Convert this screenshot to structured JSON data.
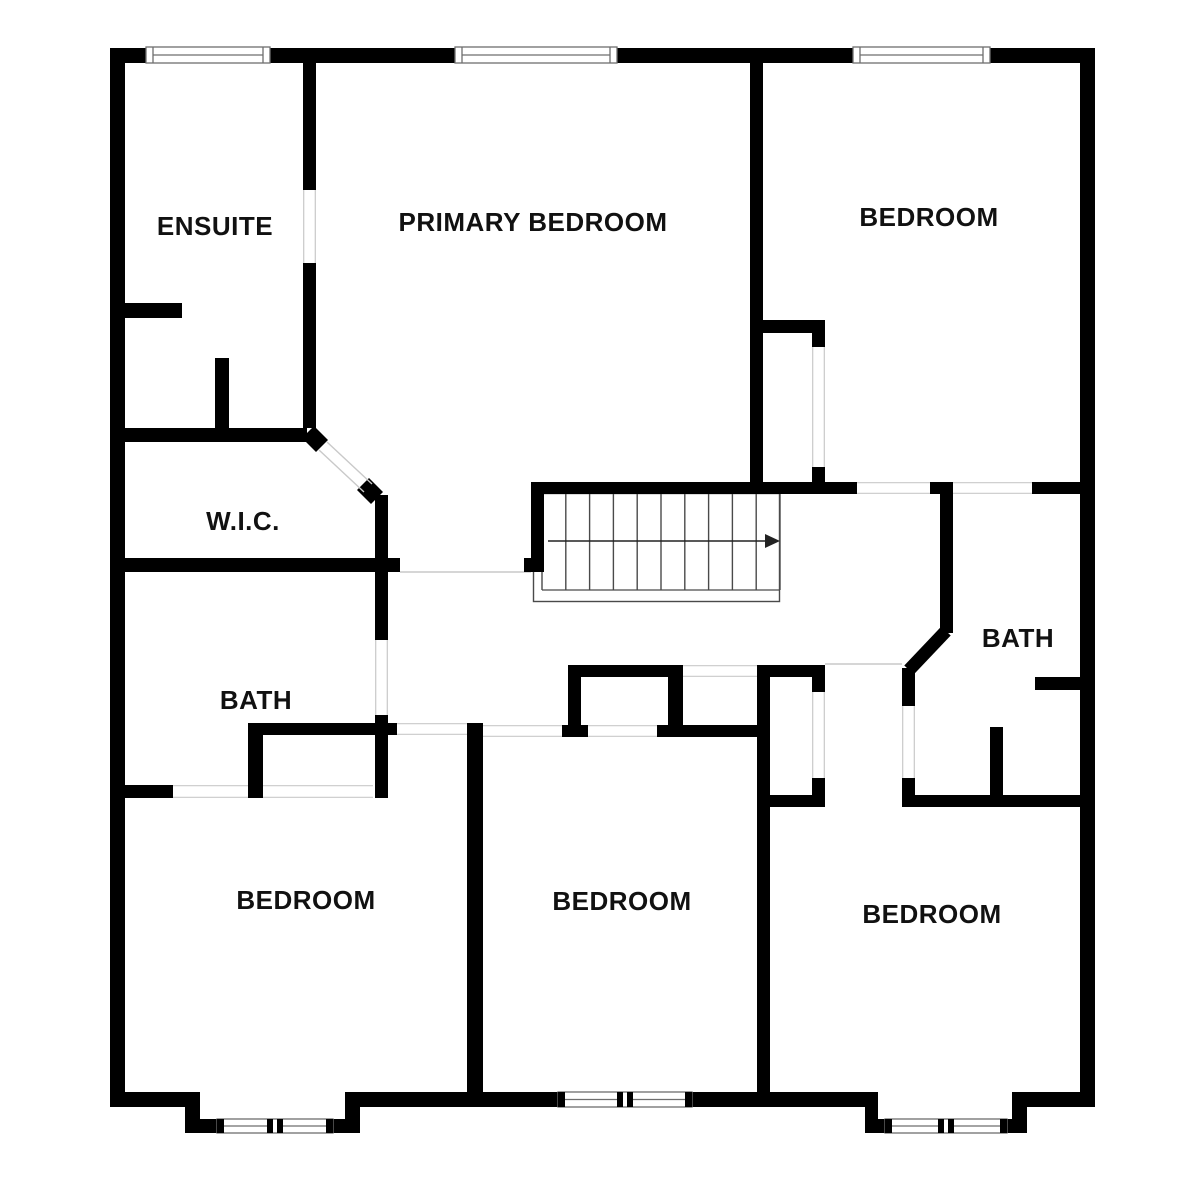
{
  "canvas": {
    "width": 1200,
    "height": 1178,
    "background": "#ffffff"
  },
  "colors": {
    "wall": "#000000",
    "opening_line": "#c9c9c9",
    "window_frame": "#6e6e6e",
    "stair_line": "#4a4a4a",
    "arrow": "#222222",
    "label": "#111111"
  },
  "rooms": [
    {
      "id": "ensuite",
      "label": "ENSUITE",
      "x": 215,
      "y": 226
    },
    {
      "id": "primary-bedroom",
      "label": "PRIMARY BEDROOM",
      "x": 533,
      "y": 222
    },
    {
      "id": "bedroom-ne",
      "label": "BEDROOM",
      "x": 929,
      "y": 217
    },
    {
      "id": "wic",
      "label": "W.I.C.",
      "x": 243,
      "y": 521
    },
    {
      "id": "bath-right",
      "label": "BATH",
      "x": 1018,
      "y": 638
    },
    {
      "id": "bath-left",
      "label": "BATH",
      "x": 256,
      "y": 700
    },
    {
      "id": "bedroom-sw",
      "label": "BEDROOM",
      "x": 306,
      "y": 900
    },
    {
      "id": "bedroom-s",
      "label": "BEDROOM",
      "x": 622,
      "y": 901
    },
    {
      "id": "bedroom-se",
      "label": "BEDROOM",
      "x": 932,
      "y": 914
    }
  ],
  "walls": [
    [
      110,
      48,
      985,
      15
    ],
    [
      110,
      48,
      15,
      1059
    ],
    [
      1080,
      48,
      15,
      1059
    ],
    [
      110,
      1092,
      90,
      15
    ],
    [
      345,
      1092,
      533,
      15
    ],
    [
      1012,
      1092,
      83,
      15
    ],
    [
      185,
      1092,
      15,
      41
    ],
    [
      345,
      1092,
      15,
      41
    ],
    [
      185,
      1119,
      33,
      14
    ],
    [
      332,
      1119,
      28,
      14
    ],
    [
      865,
      1092,
      13,
      41
    ],
    [
      1012,
      1092,
      15,
      41
    ],
    [
      865,
      1119,
      21,
      14
    ],
    [
      1006,
      1119,
      21,
      14
    ],
    [
      303,
      63,
      13,
      127
    ],
    [
      303,
      263,
      13,
      165
    ],
    [
      125,
      303,
      57,
      15
    ],
    [
      215,
      358,
      14,
      70
    ],
    [
      125,
      428,
      182,
      14
    ],
    [
      375,
      495,
      13,
      77
    ],
    [
      375,
      572,
      13,
      68
    ],
    [
      375,
      715,
      13,
      83
    ],
    [
      125,
      558,
      275,
      14
    ],
    [
      125,
      785,
      48,
      13
    ],
    [
      248,
      785,
      15,
      13
    ],
    [
      248,
      723,
      149,
      12
    ],
    [
      467,
      723,
      16,
      12
    ],
    [
      248,
      723,
      15,
      75
    ],
    [
      467,
      723,
      16,
      369
    ],
    [
      562,
      725,
      26,
      12
    ],
    [
      657,
      725,
      113,
      12
    ],
    [
      568,
      665,
      115,
      12
    ],
    [
      568,
      665,
      13,
      68
    ],
    [
      668,
      665,
      15,
      68
    ],
    [
      757,
      665,
      13,
      427
    ],
    [
      757,
      665,
      68,
      12
    ],
    [
      812,
      677,
      13,
      15
    ],
    [
      812,
      778,
      13,
      29
    ],
    [
      770,
      795,
      55,
      12
    ],
    [
      940,
      482,
      13,
      151
    ],
    [
      902,
      668,
      13,
      38
    ],
    [
      902,
      778,
      13,
      29
    ],
    [
      902,
      795,
      90,
      12
    ],
    [
      1003,
      795,
      79,
      12
    ],
    [
      990,
      727,
      13,
      80
    ],
    [
      1035,
      677,
      47,
      13
    ],
    [
      531,
      482,
      326,
      12
    ],
    [
      930,
      482,
      23,
      12
    ],
    [
      1032,
      482,
      50,
      12
    ],
    [
      750,
      63,
      13,
      419
    ],
    [
      762,
      320,
      63,
      13
    ],
    [
      812,
      333,
      13,
      14
    ],
    [
      812,
      467,
      13,
      15
    ],
    [
      531,
      482,
      13,
      90
    ],
    [
      524,
      558,
      7,
      14
    ]
  ],
  "diagonal_walls": [
    {
      "x1": 946,
      "y1": 631,
      "x2": 909,
      "y2": 670,
      "w": 13
    }
  ],
  "door_posts": [
    {
      "x1": 308,
      "y1": 432,
      "x2": 322,
      "y2": 446,
      "w": 17
    },
    {
      "x1": 363,
      "y1": 484,
      "x2": 377,
      "y2": 498,
      "w": 17
    }
  ],
  "door_leaves": [
    {
      "x1": 319,
      "y1": 450,
      "x2": 364,
      "y2": 492
    },
    {
      "x1": 327,
      "y1": 442,
      "x2": 372,
      "y2": 484
    }
  ],
  "openings": [
    {
      "x": 303,
      "y": 190,
      "w": 13,
      "h": 73,
      "dir": "v"
    },
    {
      "x": 375,
      "y": 640,
      "w": 13,
      "h": 75,
      "dir": "v"
    },
    {
      "x": 812,
      "y": 347,
      "w": 13,
      "h": 120,
      "dir": "v"
    },
    {
      "x": 812,
      "y": 692,
      "w": 13,
      "h": 86,
      "dir": "v"
    },
    {
      "x": 902,
      "y": 706,
      "w": 13,
      "h": 72,
      "dir": "v"
    },
    {
      "x": 173,
      "y": 785,
      "w": 75,
      "h": 13,
      "dir": "h"
    },
    {
      "x": 263,
      "y": 785,
      "w": 110,
      "h": 13,
      "dir": "h"
    },
    {
      "x": 397,
      "y": 723,
      "w": 70,
      "h": 12,
      "dir": "h"
    },
    {
      "x": 483,
      "y": 725,
      "w": 79,
      "h": 12,
      "dir": "h"
    },
    {
      "x": 588,
      "y": 725,
      "w": 69,
      "h": 12,
      "dir": "h"
    },
    {
      "x": 683,
      "y": 665,
      "w": 74,
      "h": 12,
      "dir": "h"
    },
    {
      "x": 857,
      "y": 482,
      "w": 73,
      "h": 12,
      "dir": "h"
    },
    {
      "x": 953,
      "y": 482,
      "w": 79,
      "h": 12,
      "dir": "h"
    }
  ],
  "lines": [
    {
      "x1": 400,
      "y1": 572,
      "x2": 531,
      "y2": 572
    },
    {
      "x1": 825,
      "y1": 664,
      "x2": 902,
      "y2": 664
    }
  ],
  "windows": [
    {
      "x": 146,
      "y": 47,
      "w": 124,
      "h": 16,
      "style": "single"
    },
    {
      "x": 455,
      "y": 47,
      "w": 162,
      "h": 16,
      "style": "single"
    },
    {
      "x": 853,
      "y": 47,
      "w": 137,
      "h": 16,
      "style": "single"
    },
    {
      "x": 217,
      "y": 1119,
      "w": 116,
      "h": 14,
      "style": "double"
    },
    {
      "x": 558,
      "y": 1092,
      "w": 134,
      "h": 15,
      "style": "double"
    },
    {
      "x": 885,
      "y": 1119,
      "w": 122,
      "h": 14,
      "style": "double"
    }
  ],
  "stairs": {
    "x": 542,
    "y": 493,
    "w": 238,
    "h": 97,
    "tread_count": 10,
    "outline": {
      "x": 533,
      "y": 493,
      "w": 246,
      "h": 108
    },
    "landing_line_y": 590,
    "arrow": {
      "x1": 548,
      "y": 541,
      "x2": 765,
      "tip_x": 780,
      "half_h": 7
    }
  }
}
